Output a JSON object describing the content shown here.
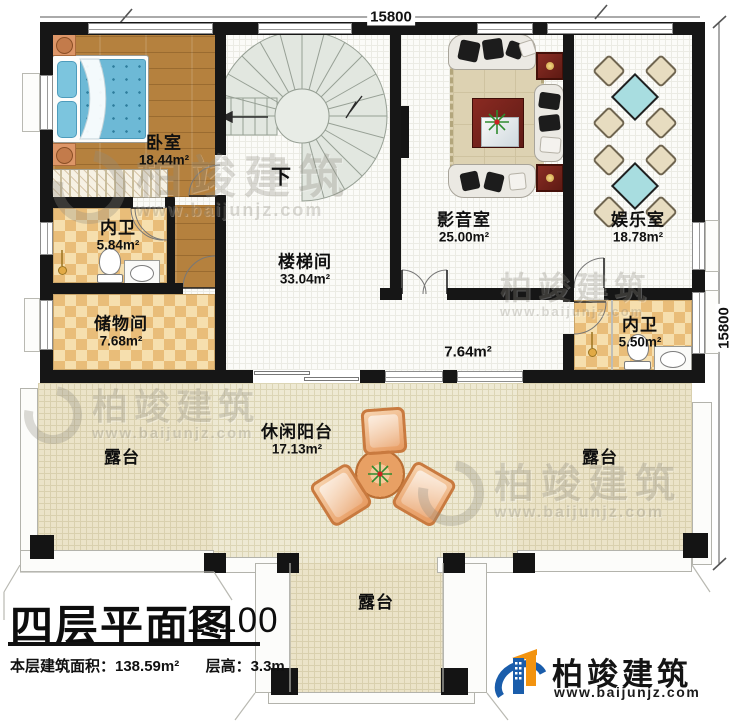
{
  "dimensions": {
    "top": "15800",
    "right": "15800"
  },
  "rooms": {
    "bedroom": {
      "name": "卧室",
      "area": "18.44m²"
    },
    "bath_left": {
      "name": "内卫",
      "area": "5.84m²"
    },
    "storage": {
      "name": "储物间",
      "area": "7.68m²"
    },
    "stairwell": {
      "name": "楼梯间",
      "area": "33.04m²"
    },
    "media": {
      "name": "影音室",
      "area": "25.00m²"
    },
    "game": {
      "name": "娱乐室",
      "area": "18.78m²"
    },
    "bath_right": {
      "name": "内卫",
      "area": "5.50m²"
    },
    "hall": {
      "area": "7.64m²"
    },
    "terrace_left": {
      "name": "露台"
    },
    "balcony": {
      "name": "休闲阳台",
      "area": "17.13m²"
    },
    "terrace_right": {
      "name": "露台"
    },
    "terrace_bottom": {
      "name": "露台"
    }
  },
  "stairs": {
    "down_label": "下"
  },
  "title_block": {
    "title": "四层平面图",
    "scale": "1:100",
    "area_info": "本层建筑面积：138.59m²",
    "height_info": "层高：3.3m"
  },
  "logo": {
    "brand": "柏竣建筑",
    "url": "www.baijunjz.com"
  },
  "watermark": {
    "brand": "柏竣建筑",
    "url": "www.baijunjz.com"
  },
  "colors": {
    "wall": "#161616",
    "wood_floor": "#b5813e",
    "tile": "#e9bd79",
    "stair": "#e2e7e0",
    "mattress": "#6db9d6",
    "game_table": "#a8dde0",
    "logo_blue": "#1a5dab",
    "logo_orange": "#f2930f"
  }
}
